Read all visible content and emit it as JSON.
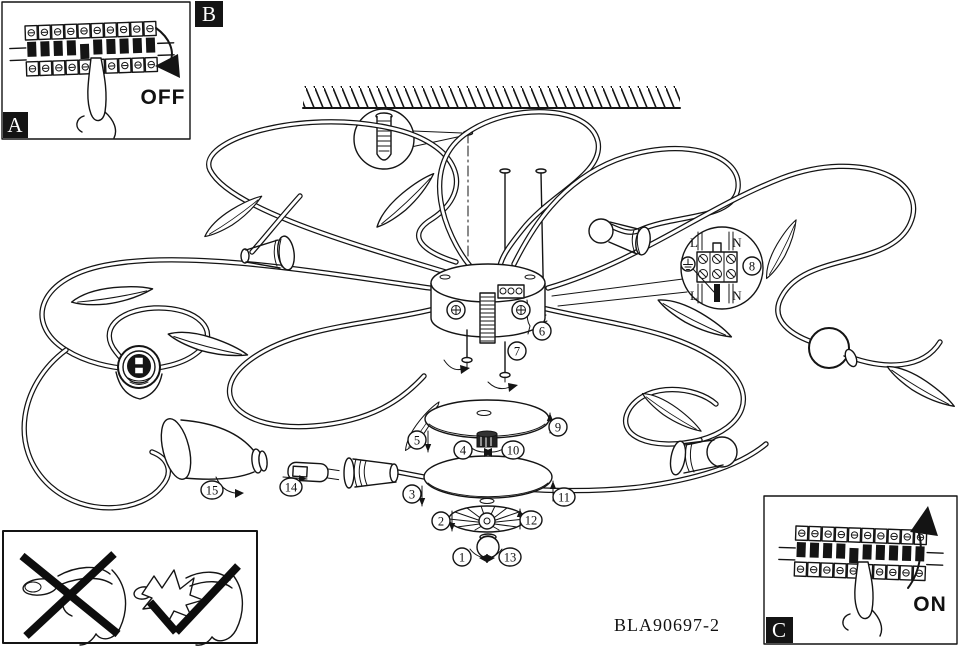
{
  "page": {
    "background": "#ffffff",
    "ink": "#141414"
  },
  "model_number": "BLA90697-2",
  "section_labels": {
    "a": "A",
    "b": "B",
    "c": "C"
  },
  "power_off": {
    "label": "OFF"
  },
  "power_on": {
    "label": "ON"
  },
  "wiring_detail": {
    "terminals": {
      "top_left": "L",
      "top_right": "N",
      "bottom_left": "L",
      "bottom_right": "N"
    }
  },
  "callouts": [
    {
      "label": "1"
    },
    {
      "label": "2"
    },
    {
      "label": "3"
    },
    {
      "label": "4"
    },
    {
      "label": "5"
    },
    {
      "label": "6"
    },
    {
      "label": "7"
    },
    {
      "label": "8"
    },
    {
      "label": "9"
    },
    {
      "label": "10"
    },
    {
      "label": "11"
    },
    {
      "label": "12"
    },
    {
      "label": "13"
    },
    {
      "label": "14"
    },
    {
      "label": "15"
    }
  ],
  "icons": {
    "earth_ground_icon": "⏚",
    "prohibition_icon": "✕",
    "approval_icon": "✓",
    "off_arrow_icon": "curved-arrow-down",
    "on_arrow_icon": "curved-arrow-up"
  }
}
